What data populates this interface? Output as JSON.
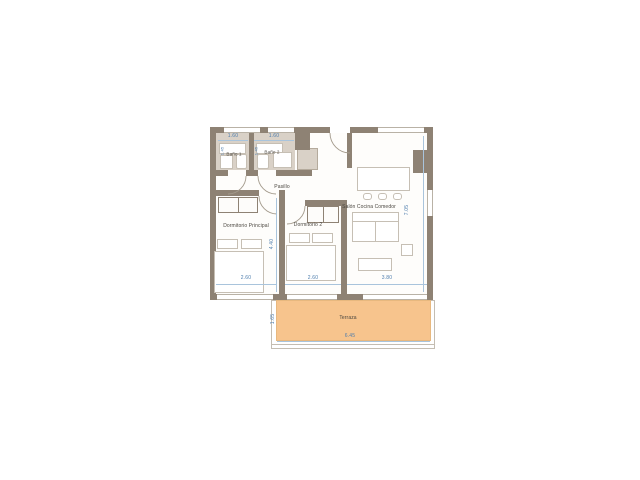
{
  "colors": {
    "wall": "#8e8274",
    "bath": "#d9d1c7",
    "terrace": "#f7c48d",
    "dim": "#4d7dad",
    "dimline": "#a9c4dc",
    "label": "#4a463f",
    "furn": "#c6bfb4"
  },
  "rooms": {
    "bath1": {
      "label": "Baño 1"
    },
    "bath2": {
      "label": "Baño 2"
    },
    "hallway": {
      "label": "Pasillo"
    },
    "bedroom_main": {
      "label": "Dormitorio Principal"
    },
    "bedroom2": {
      "label": "Dormitorio 2"
    },
    "living": {
      "label": "Salón Cocina Comedor"
    },
    "terrace": {
      "label": "Terraza"
    }
  },
  "dims": {
    "bath1_width": "1.60",
    "bath2_width": "1.60",
    "bedroom_main_width": "2.60",
    "bedroom2_width": "2.60",
    "living_width": "3.80",
    "bedroom_depth": "4.40",
    "living_depth": "7.05",
    "terrace_depth": "1.65",
    "terrace_width": "6.45",
    "bath1_depth": "1.45",
    "bath2_depth": "1.45"
  }
}
